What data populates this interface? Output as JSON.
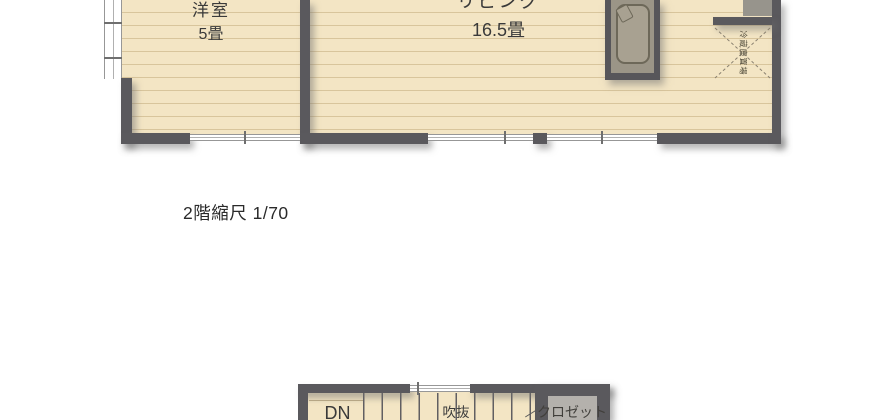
{
  "plan2": {
    "room1": {
      "name": "洋室",
      "size": "5畳"
    },
    "room2": {
      "name": "リビング",
      "size": "16.5畳"
    },
    "fridge_label": "冷蔵庫置場",
    "caption": "2階縮尺 1/70"
  },
  "plan1": {
    "stairs_label": "DN",
    "void_label": "吹抜",
    "closet_label": "クロゼット"
  },
  "colors": {
    "floor": "#f3e5c4",
    "floor_stripe": "#ddc9a1",
    "wall": "#5a595d",
    "counter": "#9b9587",
    "closet_inner": "#b4b1ac",
    "text": "#3a3a3a"
  }
}
